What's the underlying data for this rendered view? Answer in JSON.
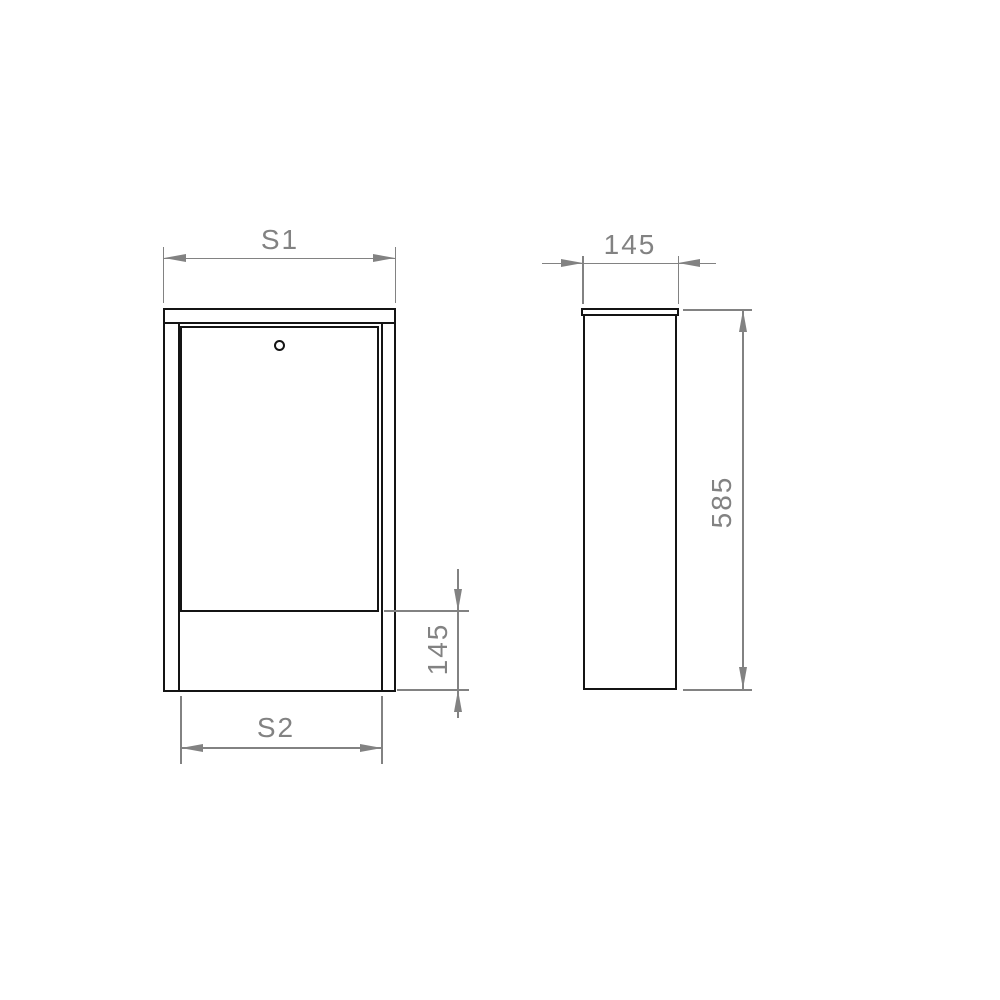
{
  "drawing": {
    "kind": "technical-drawing",
    "colors": {
      "outline": "#141414",
      "dimension": "#828282",
      "background": "#ffffff"
    },
    "dims": {
      "s1": {
        "label": "S1"
      },
      "s2": {
        "label": "S2"
      },
      "front_base_height": {
        "label": "145"
      },
      "side_depth": {
        "label": "145"
      },
      "side_height": {
        "label": "585"
      }
    }
  }
}
